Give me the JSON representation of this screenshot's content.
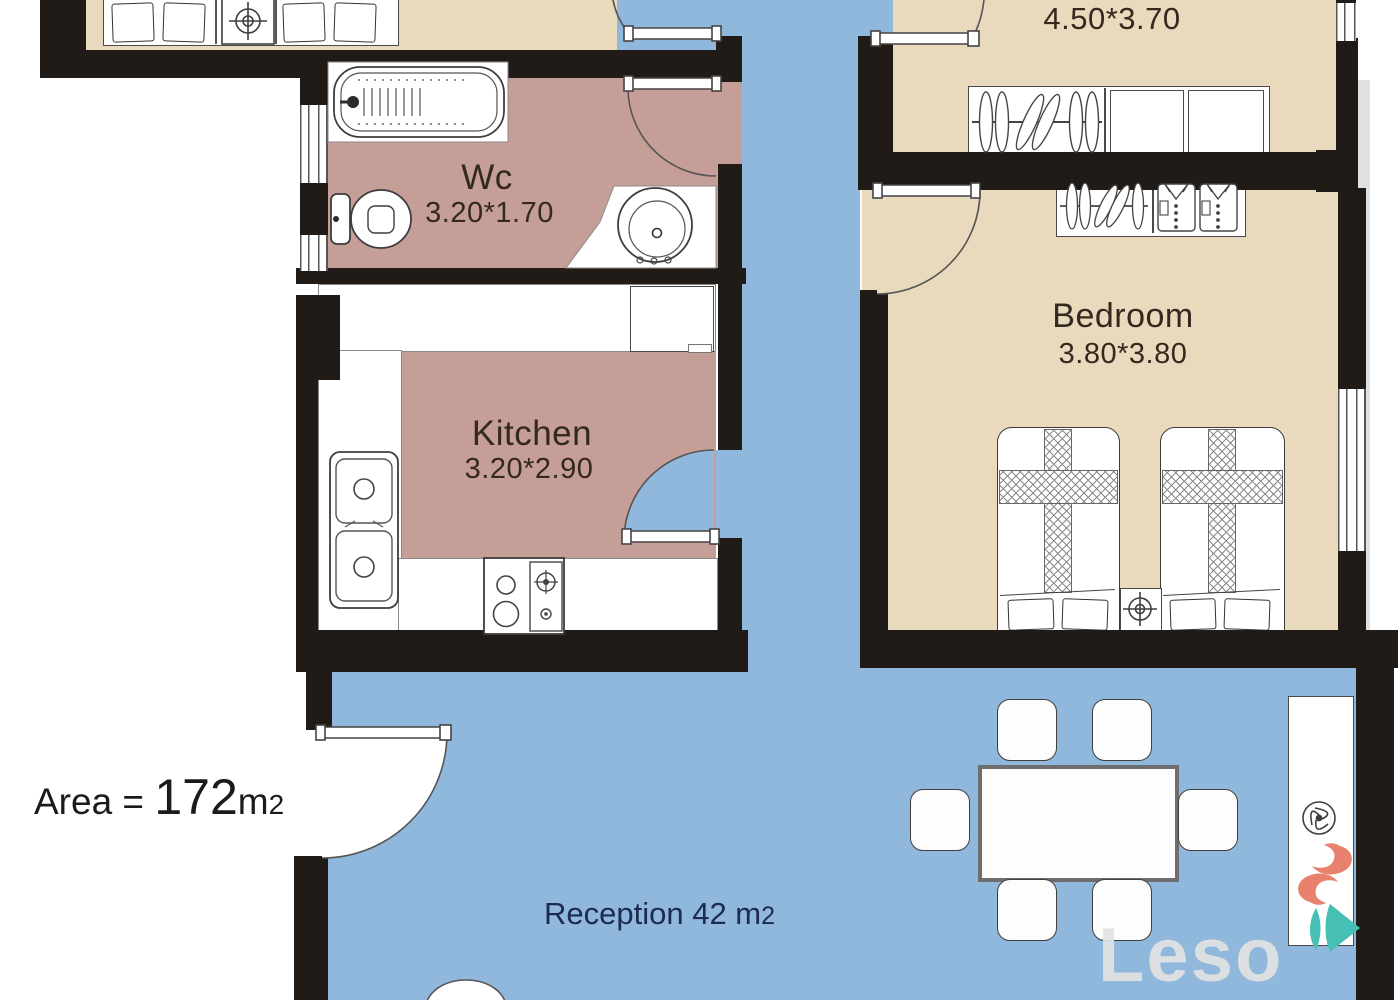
{
  "labels": {
    "wc": {
      "name": "Wc",
      "dims": "3.20*1.70"
    },
    "kitchen": {
      "name": "Kitchen",
      "dims": "3.20*2.90"
    },
    "bedroom": {
      "name": "Bedroom",
      "dims": "3.80*3.80"
    },
    "top_right_room": {
      "dims": "4.50*3.70"
    },
    "reception": {
      "name_and_area": "Reception 42 m",
      "area_sup": "2"
    },
    "area": {
      "prefix": "Area = ",
      "value": "172",
      "unit": "m",
      "unit_sub": "2"
    },
    "watermark": "Leso"
  },
  "colors": {
    "wall": "#211b17",
    "bedroom_floor": "#e9d9bd",
    "wet_room_floor": "#c69e98",
    "living_floor": "#90b7dc",
    "room_label_ink": "#33291f",
    "reception_ink": "#1d2b4e",
    "logo_salmon": "#e8826e",
    "logo_teal": "#45c0b2"
  }
}
